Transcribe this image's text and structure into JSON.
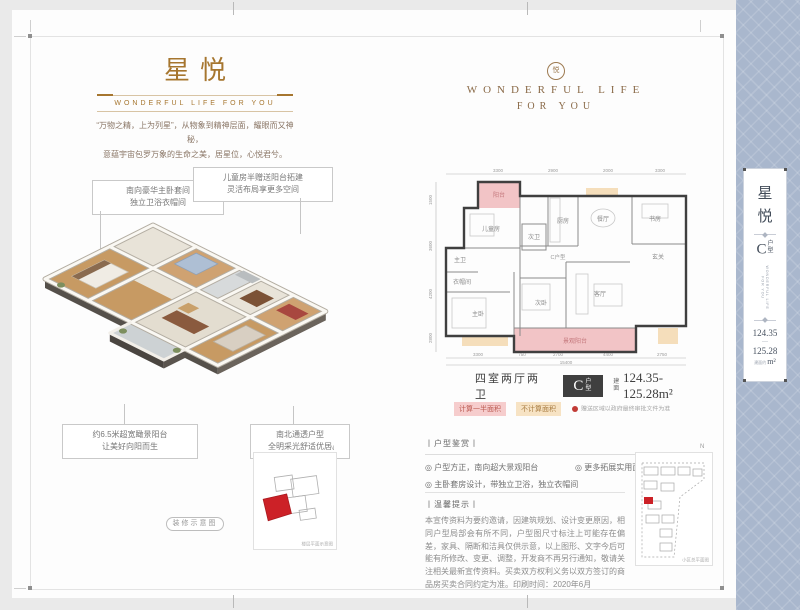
{
  "page": {
    "bg": "#eaeaea",
    "accent_brown": "#a6762f",
    "panel_blue": "#a9b7cd"
  },
  "left_page": {
    "title": "星悦",
    "subtitle": "WONDERFUL LIFE FOR YOU",
    "tagline_1": "“万物之精，上为列星”，从物象到精神层面，耀眼而又神秘，",
    "tagline_2": "意蕴宇宙包罗万象的生命之美，居星位，心悦君兮。",
    "callouts": [
      {
        "line1": "南向豪华主卧套间",
        "line2": "独立卫浴衣帽间"
      },
      {
        "line1": "儿童房半赠送阳台拓建",
        "line2": "灵活布局享更多空间"
      },
      {
        "line1": "约6.5米超宽瞰景阳台",
        "line2": "让美好向阳而生"
      },
      {
        "line1": "南北通透户型",
        "line2": "全明采光舒适优居"
      }
    ],
    "render_pill": "装修示意图",
    "keyplan_caption": "楼层平面示意图",
    "keyplan_north": "N"
  },
  "right_page": {
    "logo_char": "悦",
    "brand_line1": "WONDERFUL LIFE",
    "brand_line2": "FOR YOU",
    "floorplan": {
      "rooms": [
        "阳台",
        "儿童房",
        "主卫",
        "衣帽间",
        "主卧",
        "次卫",
        "厨房",
        "餐厅",
        "书房",
        "玄关",
        "次卧",
        "客厅",
        "景观阳台"
      ],
      "center_label": "C户型",
      "dims_top": [
        "3300",
        "2900",
        "2000",
        "3300"
      ],
      "dims_left": [
        "1500",
        "3600",
        "4200",
        "2800"
      ],
      "dims_bottom": [
        "3300",
        "750",
        "2700",
        "4400",
        "2750"
      ],
      "dims_bottom_total": "15400"
    },
    "spec": {
      "layout": "四室两厅两卫",
      "type_big": "C",
      "type_small": "户型",
      "area_prefix": "建面",
      "area_range": "124.35-125.28m²"
    },
    "legend": {
      "half": "计算一半面积",
      "none": "不计算面积",
      "note": "赠送区域以政府最终审批文件为准"
    },
    "appreciation": {
      "title": "丨户型鉴赏丨",
      "b1": "◎ 户型方正，南向超大景观阳台",
      "b2": "◎ 更多拓展实用面积，铺排奢适生活",
      "b3": "◎ 主卧套房设计，带独立卫浴，独立衣帽间"
    },
    "notice": {
      "title": "丨温馨提示丨",
      "body": "本宣传资料为要约邀请，因建筑规划、设计变更原因，相同户型局部会有所不同，户型图尺寸标注上可能存在偏差，家具、隔断和洁具仅供示意，以上图形、文字今后可能有所修改、变更、调整，开发商不再另行通知，敬请关注相关最新宣传资料。买卖双方权利义务以双方签订的商品房买卖合同约定为准。印刷时间：2020年6月"
    },
    "siteplan_caption": "小区总平面图",
    "siteplan_north": "N"
  },
  "sidebar": {
    "title_char1": "星",
    "title_char2": "悦",
    "type_big": "C",
    "type_small": "户型",
    "vertical_caption": "WONDERFUL LIFE FOR YOU",
    "area_1": "124.35",
    "area_dash": "—",
    "area_2": "125.28",
    "area_prefix": "建面约",
    "area_unit": "m²"
  }
}
